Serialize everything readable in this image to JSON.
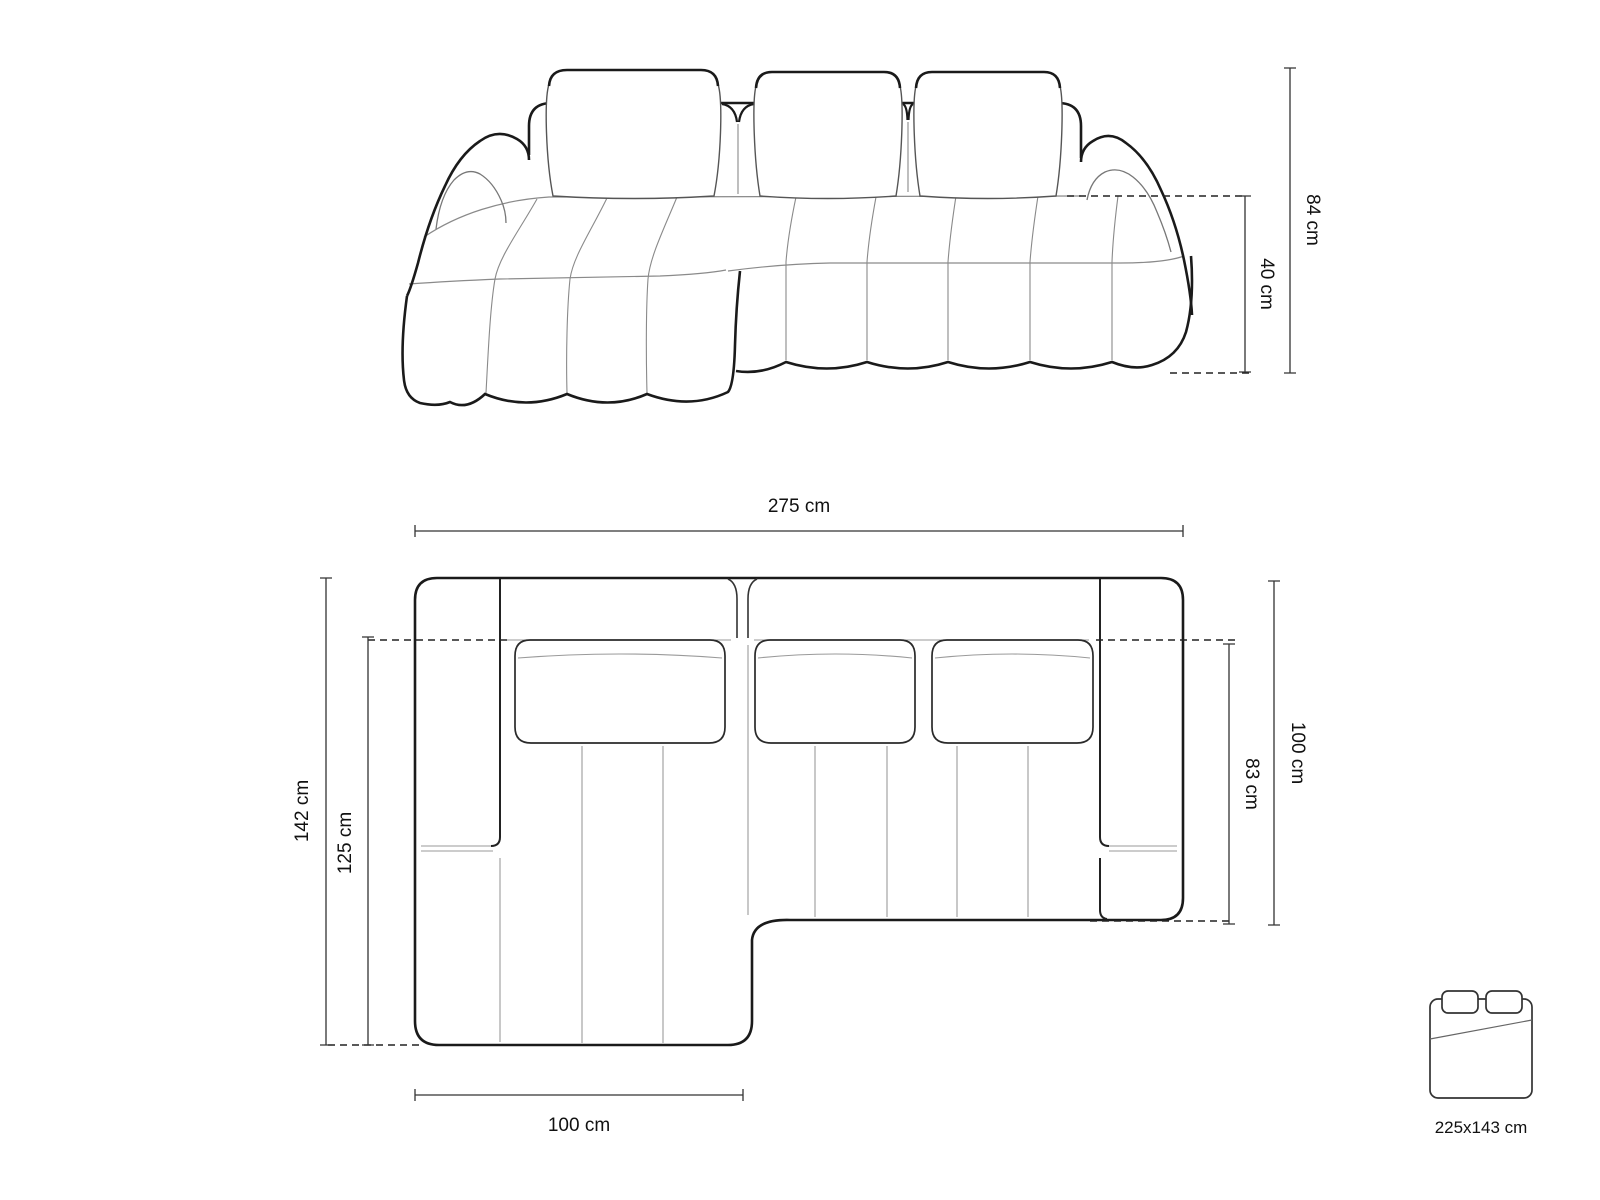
{
  "colors": {
    "background": "#ffffff",
    "outline": "#1a1a1a",
    "seam": "#909090",
    "dimension_line": "#333333",
    "text": "#111111"
  },
  "dimensions": {
    "total_height": "84 cm",
    "seat_height": "40 cm",
    "total_width": "275 cm",
    "total_depth": "142 cm",
    "chaise_inner_depth": "125 cm",
    "side_depth": "100 cm",
    "inner_seat_depth": "83 cm",
    "chaise_width": "100 cm"
  },
  "sleeping_area": {
    "icon": "bed-icon",
    "label": "225x143 cm"
  }
}
